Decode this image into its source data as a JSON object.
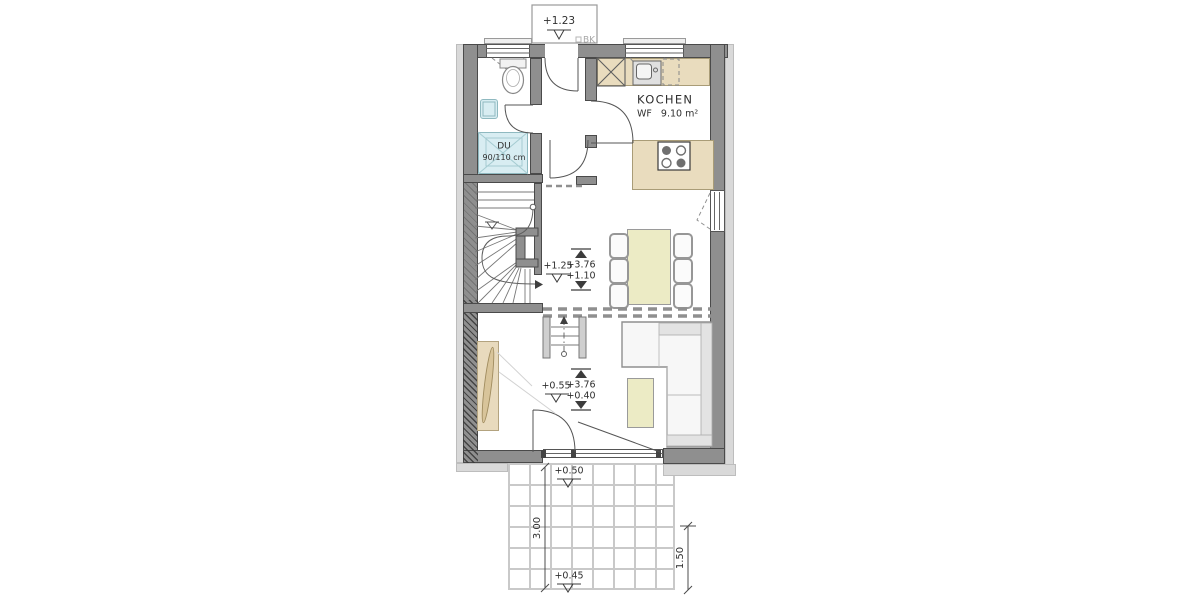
{
  "plan": {
    "type": "architectural-floor-plan",
    "colors": {
      "wall": "#8f8f8f",
      "wall_render": "#d9d9d9",
      "counter_beige": "#e9dcbe",
      "furniture_cream": "#ecebc5",
      "sanitary_cyan": "#d8edf2",
      "linework": "#555555",
      "text": "#2f2f2f",
      "muted_text": "#a8a8a8"
    },
    "labels": {
      "canopy_level": "+1.23",
      "bk": "BK",
      "kitchen_name": "KOCHEN",
      "kitchen_area": "WF   9.10 m²",
      "shower_type": "DU",
      "shower_size": "90/110 cm",
      "stair_level": "+1.25",
      "dining_ceiling": "+3.76",
      "dining_floor": "+1.10",
      "living_level": "+0.55",
      "living_ceiling": "+3.76",
      "living_floor": "+0.40",
      "terrace_upper": "+0.50",
      "terrace_lower": "+0.45",
      "terrace_depth": "3.00",
      "terrace_side": "1.50"
    }
  }
}
